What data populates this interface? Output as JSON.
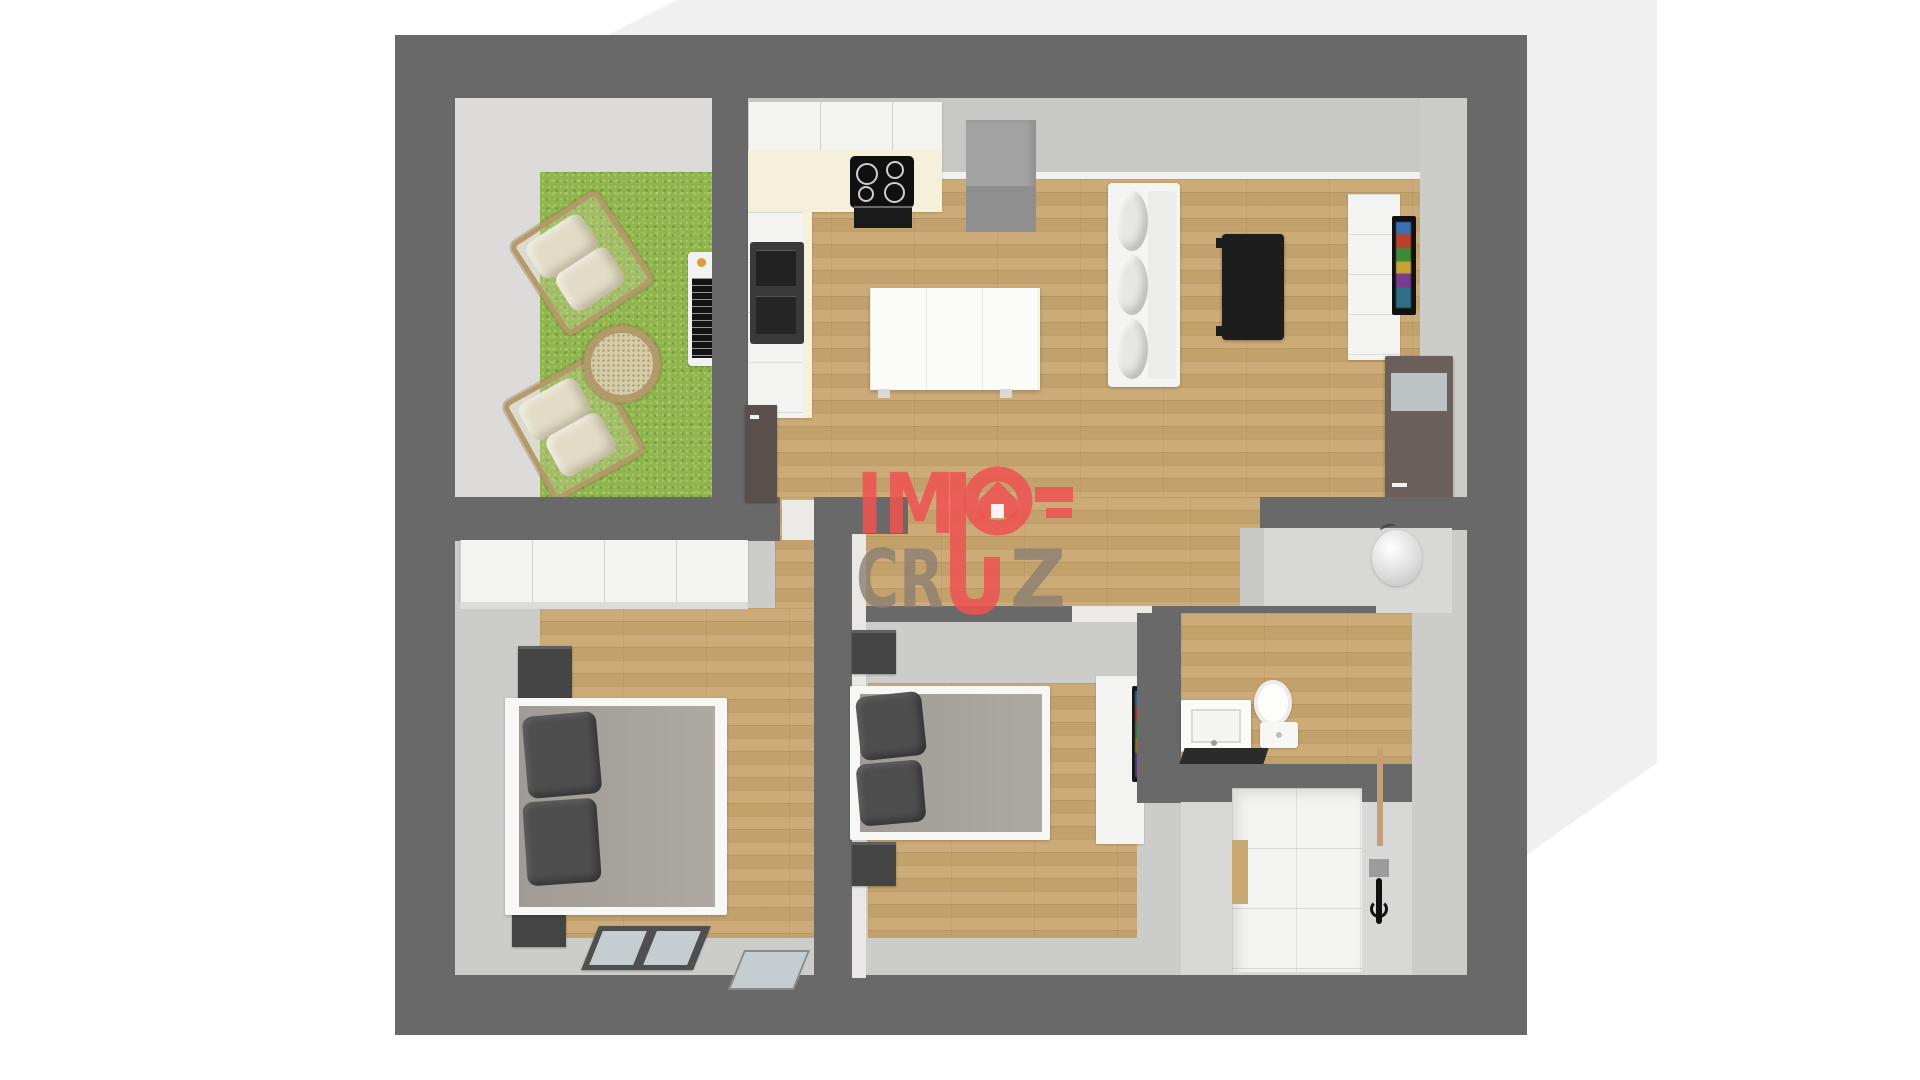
{
  "scene": "3d-floor-plan-top-view",
  "watermark": {
    "brand": "IMO-CRUZ",
    "im": "IM",
    "o": "O",
    "cr": "CR",
    "u": "U",
    "z": "Z"
  },
  "colors": {
    "wall": "#696969",
    "base-face": "#cccccb",
    "band": "#c7c7c5",
    "terrace": "#dcdbd9",
    "floor-light": "#d8d8d6",
    "wood": "#c9a771",
    "grass": "#8fb54d",
    "bg-shadow": "#f0f0f0",
    "logo-red": "#ed5351",
    "logo-gray": "#8b8072",
    "door": "#5a4f4b",
    "entry-door": "#6b5f5b",
    "mattress": "#a8a49d",
    "pillow": "#4e4e4e",
    "dark-furniture": "#454545",
    "white-furniture": "#f3f3f1",
    "cream": "#f5f0da",
    "glass": "#c6cdd0",
    "fridge": "#a3a3a3"
  }
}
